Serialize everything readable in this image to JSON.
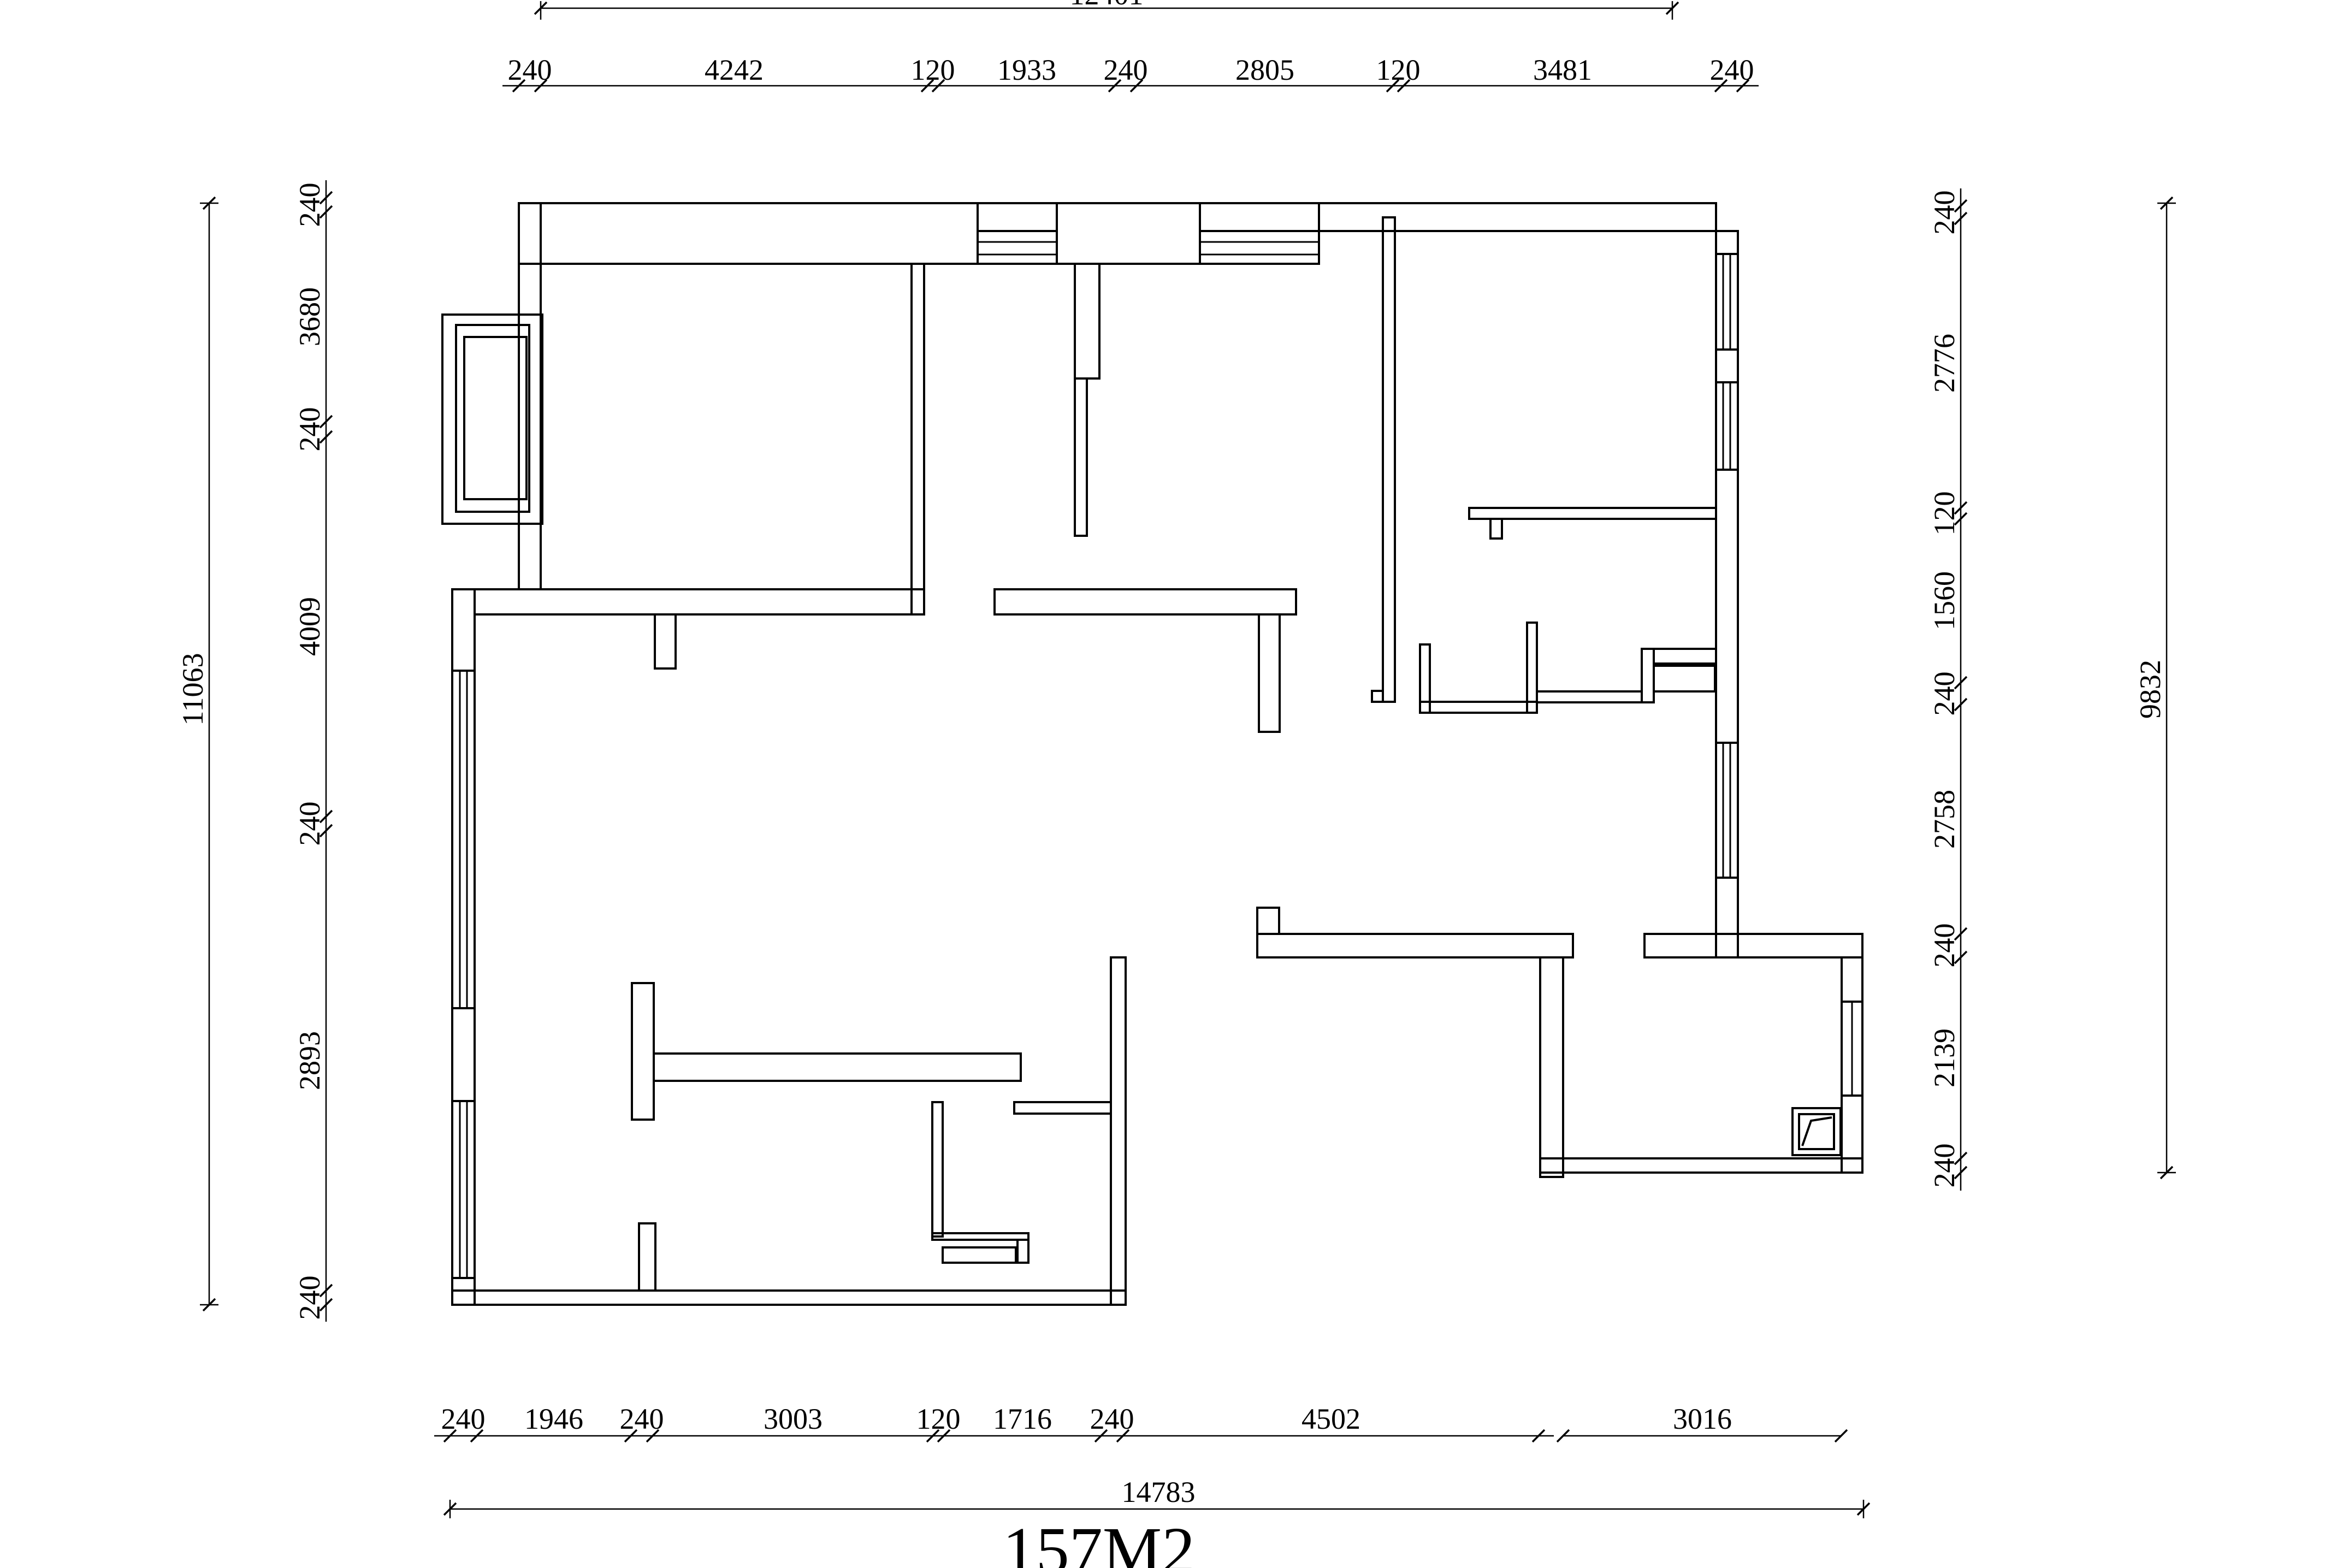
{
  "title": "157M2",
  "dimensions": {
    "top": {
      "total": "12401",
      "segments": [
        "240",
        "4242",
        "120",
        "1933",
        "240",
        "2805",
        "120",
        "3481",
        "240"
      ]
    },
    "bottom": {
      "total": "14783",
      "segments": [
        "240",
        "1946",
        "240",
        "3003",
        "120",
        "1716",
        "240",
        "4502",
        "3016"
      ]
    },
    "left": {
      "total": "11063",
      "segments": [
        "240",
        "3680",
        "240",
        "4009",
        "240",
        "2893",
        "240"
      ]
    },
    "right": {
      "total": "9832",
      "segments": [
        "240",
        "2776",
        "120",
        "1560",
        "240",
        "2758",
        "240",
        "2139",
        "240"
      ]
    }
  },
  "colors": {
    "line": "#000000",
    "background": "#ffffff"
  }
}
